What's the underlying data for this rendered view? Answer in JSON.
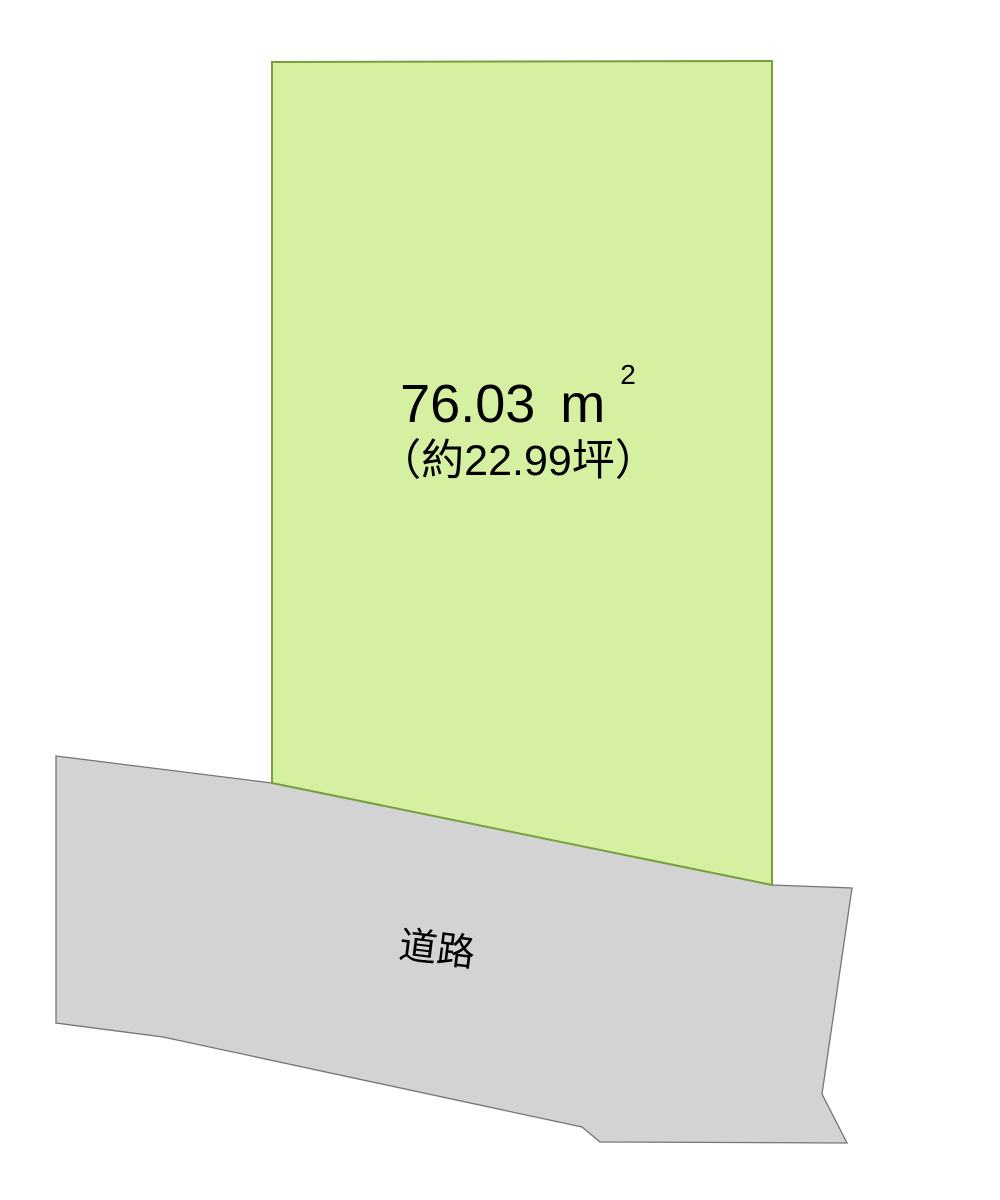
{
  "diagram": {
    "type": "land-plot-layout",
    "background": "#ffffff"
  },
  "plot": {
    "area_value": "76.03",
    "area_unit_base": "m",
    "area_unit_exponent": "2",
    "area_tsubo": "（約22.99坪）",
    "fill_color": "#d6f0a2",
    "stroke_color": "#75a03d"
  },
  "road": {
    "label": "道路",
    "fill_color": "#d3d3d3",
    "stroke_color": "#757575"
  },
  "text_color": "#000000"
}
